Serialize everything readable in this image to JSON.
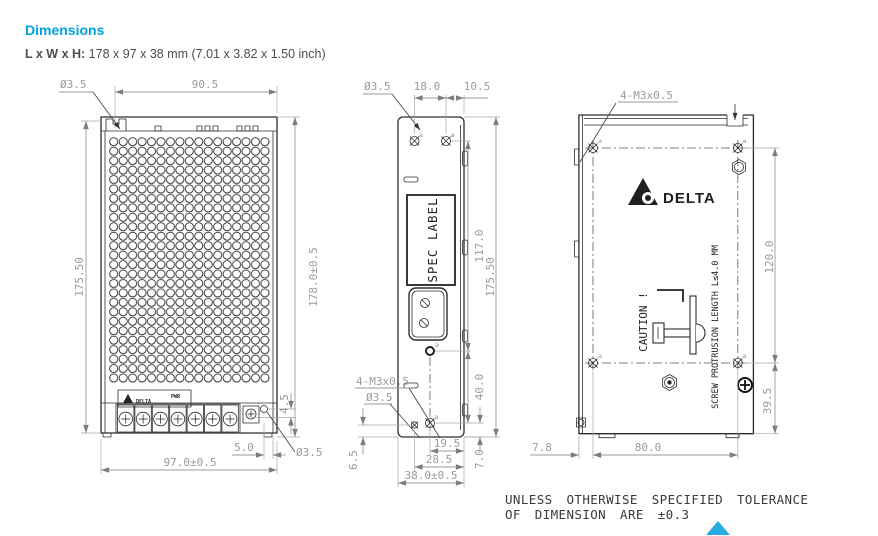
{
  "header": {
    "title": "Dimensions",
    "lwh_label": "L x W x H:",
    "lwh_value": " 178 x 97 x 38 mm (7.01 x 3.82 x 1.50 inch)"
  },
  "drawing": {
    "datum": "a",
    "front_view": {
      "hole_top": "Ø3.5",
      "width_top": "90.5",
      "height_left": "175.50",
      "height_right": "178.0±0.5",
      "offset_4_5": "4.5",
      "offset_5_0": "5.0",
      "hole_bottom": "Ø3.5",
      "width_bottom": "97.0±0.5",
      "label_brand": "DELTA",
      "label_pwr": "PWR"
    },
    "side_view": {
      "hole_top": "Ø3.5",
      "spacing_top": "18.0",
      "offset_top": "10.5",
      "spec_label": "SPEC LABEL",
      "height_117": "117.0",
      "height_total": "175.50",
      "spacing_40": "40.0",
      "thread_label": "4-M3x0.5",
      "hole_bottom": "Ø3.5",
      "offset_6_5": "6.5",
      "offset_7_0": "7.0",
      "offset_19_5": "19.5",
      "offset_28_5": "28.5",
      "width_total": "38.0±0.5"
    },
    "back_view": {
      "thread_label": "4-M3x0.5",
      "brand": "DELTA",
      "caution": "CAUTION !",
      "protrusion_note": "SCREW PROTRUSION LENGTH L≤4.0 MM",
      "spacing_120": "120.0",
      "offset_39_5": "39.5",
      "offset_7_8": "7.8",
      "spacing_80": "80.0"
    }
  },
  "footer": {
    "tolerance_line1": "UNLESS OTHERWISE SPECIFIED TOLERANCE",
    "tolerance_line2": "OF DIMENSION ARE ±0.3",
    "scroll_top_icon": "up-triangle"
  },
  "colors": {
    "accent": "#00A3E0",
    "outline": "#2D2D2D",
    "dimension": "#9A9A9A",
    "scroll_triangle": "#29ABE2"
  }
}
